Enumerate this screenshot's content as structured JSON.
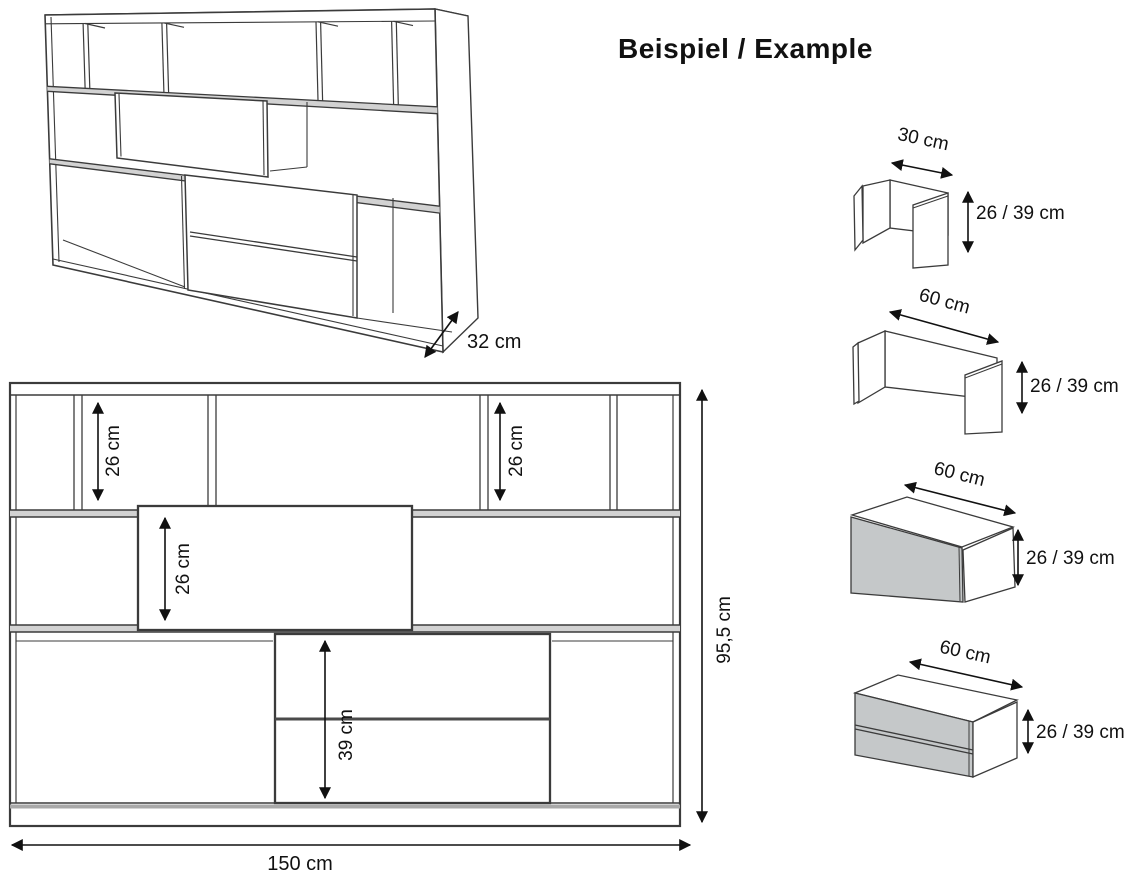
{
  "heading": "Beispiel / Example",
  "perspective": {
    "depth_label": "32 cm"
  },
  "elevation": {
    "width_label": "150 cm",
    "height_label": "95,5 cm",
    "top_left_shelf_label": "26 cm",
    "top_right_shelf_label": "26 cm",
    "door_label": "26 cm",
    "drawer_label": "39 cm"
  },
  "modules": [
    {
      "name": "open-module-30",
      "width_label": "30 cm",
      "height_label": "26 / 39 cm"
    },
    {
      "name": "open-module-60",
      "width_label": "60 cm",
      "height_label": "26 / 39 cm"
    },
    {
      "name": "door-module-60",
      "width_label": "60 cm",
      "height_label": "26 / 39 cm"
    },
    {
      "name": "drawer-module-60",
      "width_label": "60 cm",
      "height_label": "26 / 39 cm"
    }
  ],
  "colors": {
    "line": "#3b3b3b",
    "annotation": "#111111",
    "front_gray": "#c5c8c9",
    "shelf_gray": "#d2d2d2"
  }
}
